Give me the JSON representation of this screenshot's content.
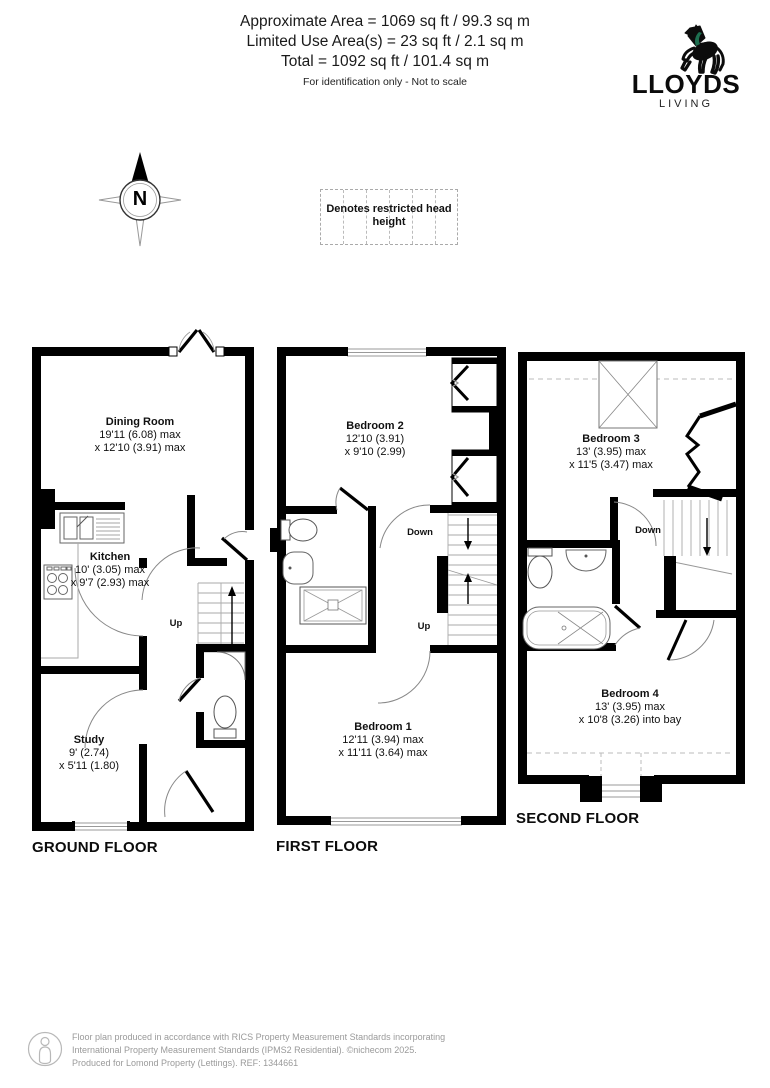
{
  "header": {
    "line1": "Approximate Area = 1069 sq ft / 99.3 sq m",
    "line2": "Limited Use Area(s) = 23 sq ft / 2.1 sq m",
    "line3": "Total = 1092 sq ft / 101.4 sq m",
    "note": "For identification only - Not to scale"
  },
  "logo": {
    "brand": "LLOYDS",
    "sub": "LIVING"
  },
  "compass": {
    "label": "N"
  },
  "legend": {
    "text": "Denotes restricted head height"
  },
  "floors": {
    "ground": {
      "title": "GROUND FLOOR",
      "up": "Up",
      "dining": {
        "name": "Dining Room",
        "dim1": "19'11 (6.08) max",
        "dim2": "x 12'10 (3.91) max"
      },
      "kitchen": {
        "name": "Kitchen",
        "dim1": "10' (3.05) max",
        "dim2": "x 9'7 (2.93) max"
      },
      "study": {
        "name": "Study",
        "dim1": "9' (2.74)",
        "dim2": "x 5'11 (1.80)"
      }
    },
    "first": {
      "title": "FIRST FLOOR",
      "down": "Down",
      "up": "Up",
      "bedroom2": {
        "name": "Bedroom 2",
        "dim1": "12'10 (3.91)",
        "dim2": "x 9'10 (2.99)"
      },
      "bedroom1": {
        "name": "Bedroom 1",
        "dim1": "12'11 (3.94) max",
        "dim2": "x 11'11 (3.64) max"
      }
    },
    "second": {
      "title": "SECOND FLOOR",
      "down": "Down",
      "bedroom3": {
        "name": "Bedroom 3",
        "dim1": "13' (3.95) max",
        "dim2": "x 11'5 (3.47) max"
      },
      "bedroom4": {
        "name": "Bedroom 4",
        "dim1": "13' (3.95) max",
        "dim2": "x 10'8 (3.26) into bay"
      }
    }
  },
  "footer": {
    "line1": "Floor plan produced in accordance with RICS Property Measurement Standards incorporating",
    "line2": "International Property Measurement Standards (IPMS2 Residential).  ©nichecom 2025.",
    "line3": "Produced for Lomond Property (Lettings).   REF:  1344661"
  },
  "colors": {
    "wall": "#000000",
    "brand_green": "#1e6f50",
    "muted": "#9a9a9a"
  }
}
